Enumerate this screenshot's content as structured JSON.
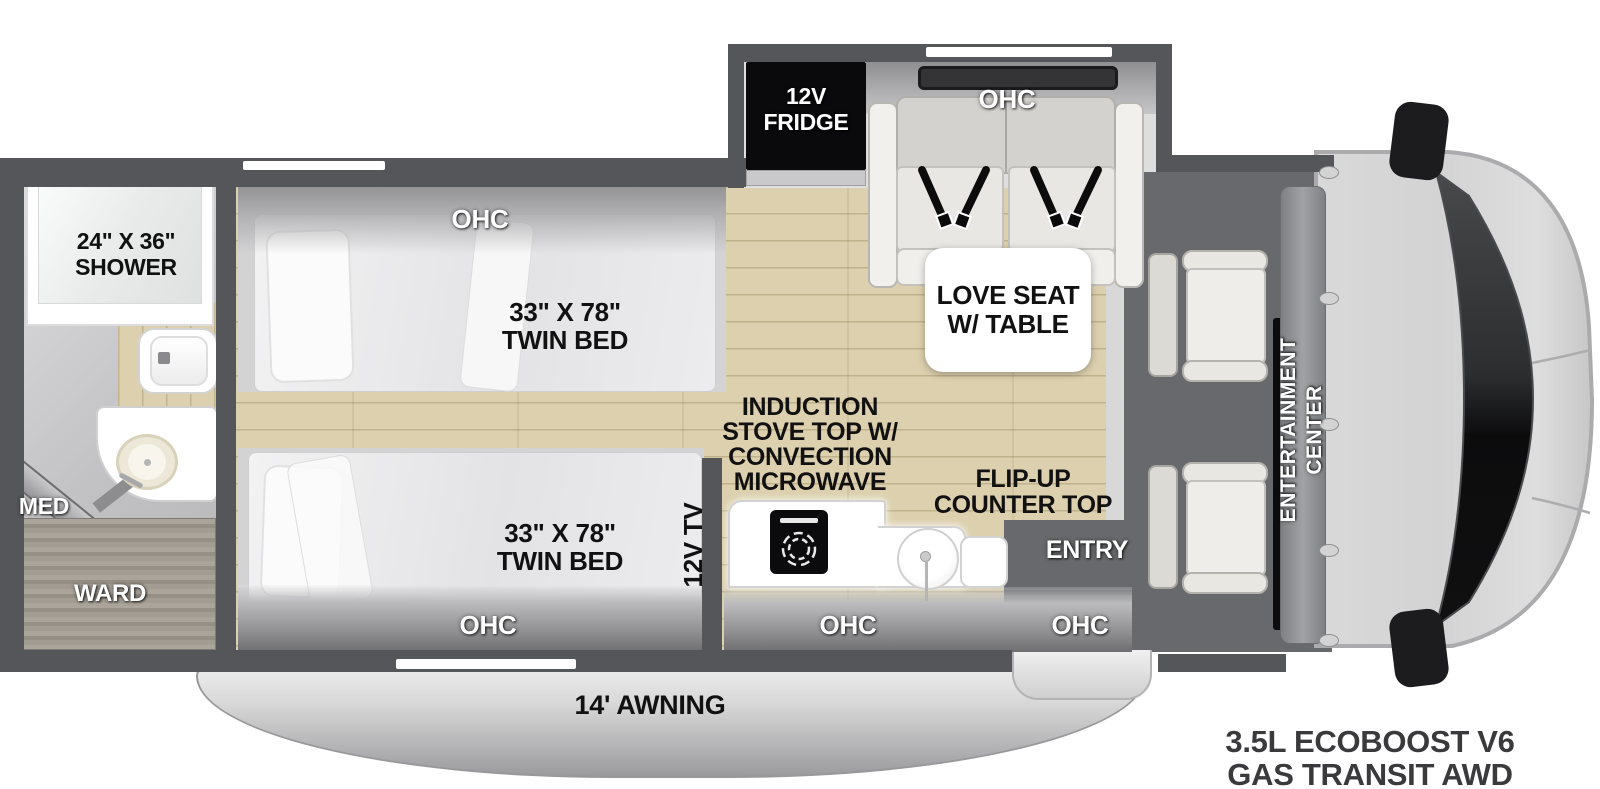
{
  "floorplan": {
    "slideout": {
      "fridge_label": "12V\nFRIDGE",
      "ohc_label": "OHC",
      "love_seat_label": "LOVE SEAT\nW/ TABLE"
    },
    "bathroom": {
      "shower_label": "24\" X 36\"\nSHOWER",
      "med_label": "MED",
      "ward_label": "WARD"
    },
    "bedroom": {
      "ohc_top_label": "OHC",
      "bed_top_label": "33\" X 78\"\nTWIN BED",
      "bed_bottom_label": "33\" X 78\"\nTWIN BED",
      "ohc_bottom_label": "OHC",
      "tv_label": "12V TV"
    },
    "kitchen": {
      "stove_label": "INDUCTION\nSTOVE TOP W/\nCONVECTION\nMICROWAVE",
      "counter_label": "FLIP-UP\nCOUNTER TOP",
      "ohc_label": "OHC"
    },
    "entry": {
      "entry_label": "ENTRY",
      "ohc_label": "OHC"
    },
    "cab": {
      "entertainment_label": "ENTERTAINMENT\nCENTER"
    },
    "exterior": {
      "awning_label": "14' AWNING",
      "engine_label": "3.5L ECOBOOST V6\nGAS TRANSIT AWD"
    }
  },
  "colors": {
    "wall": "#54565a",
    "wood_floor": "#dcd0ae",
    "cab_floor": "#67696c",
    "appliance_black": "#0b0b0d",
    "mattress": "#ececee",
    "awning_gray": "#c4c4c6"
  }
}
